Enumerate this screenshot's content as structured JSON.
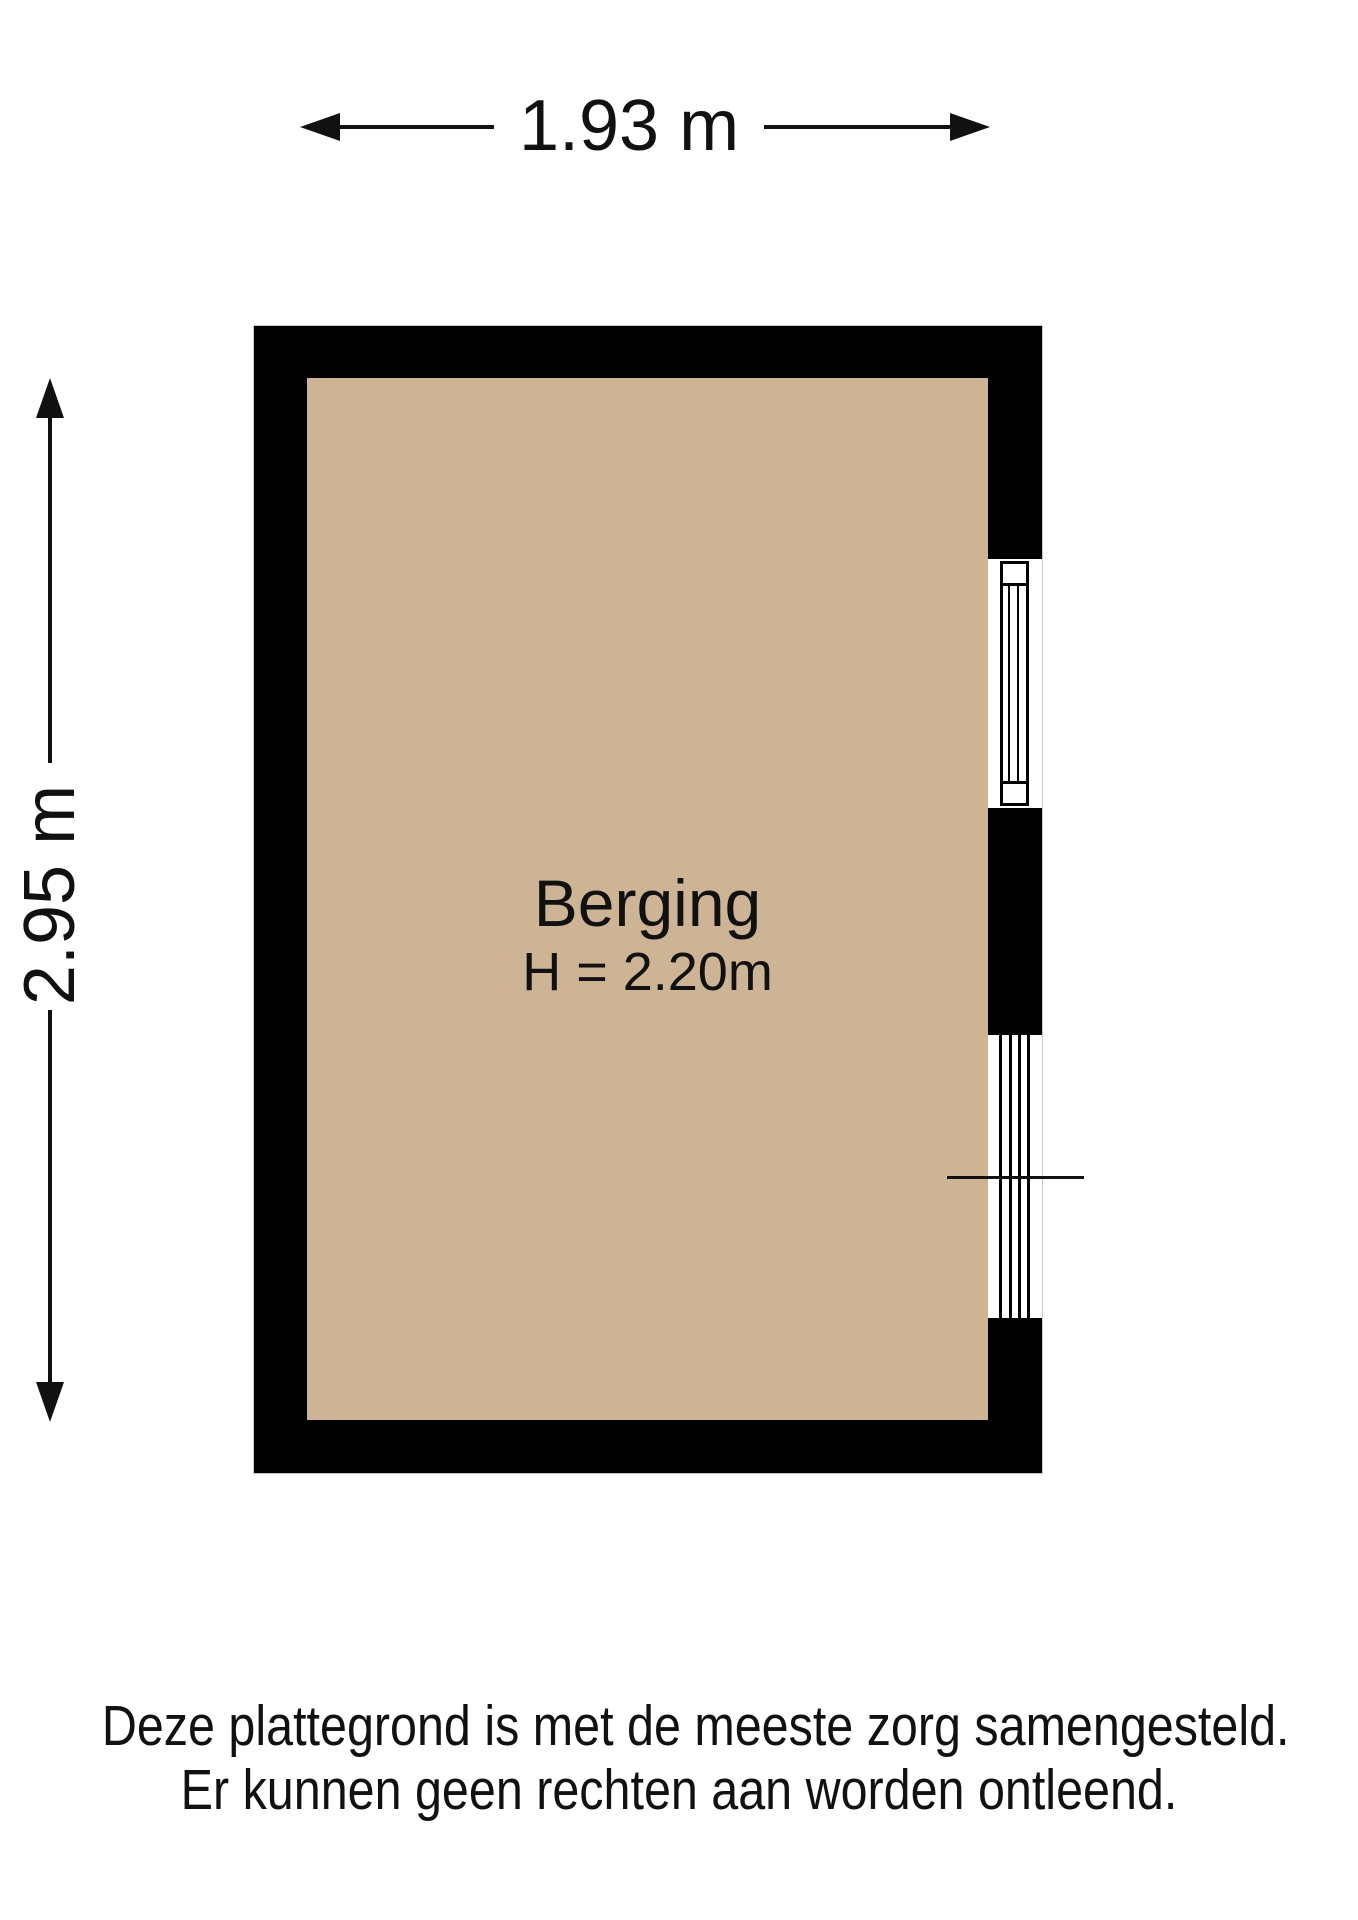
{
  "floorplan": {
    "width_dimension": "1.93 m",
    "height_dimension": "2.95 m",
    "room": {
      "name": "Berging",
      "ceiling_height": "H = 2.20m"
    },
    "disclaimer_line1": "Deze plattegrond is met de meeste zorg samengesteld.",
    "disclaimer_line2": "Er kunnen geen rechten aan worden ontleend.",
    "colors": {
      "floor": "#cdb494",
      "wall": "#000000",
      "line": "#111111"
    }
  }
}
